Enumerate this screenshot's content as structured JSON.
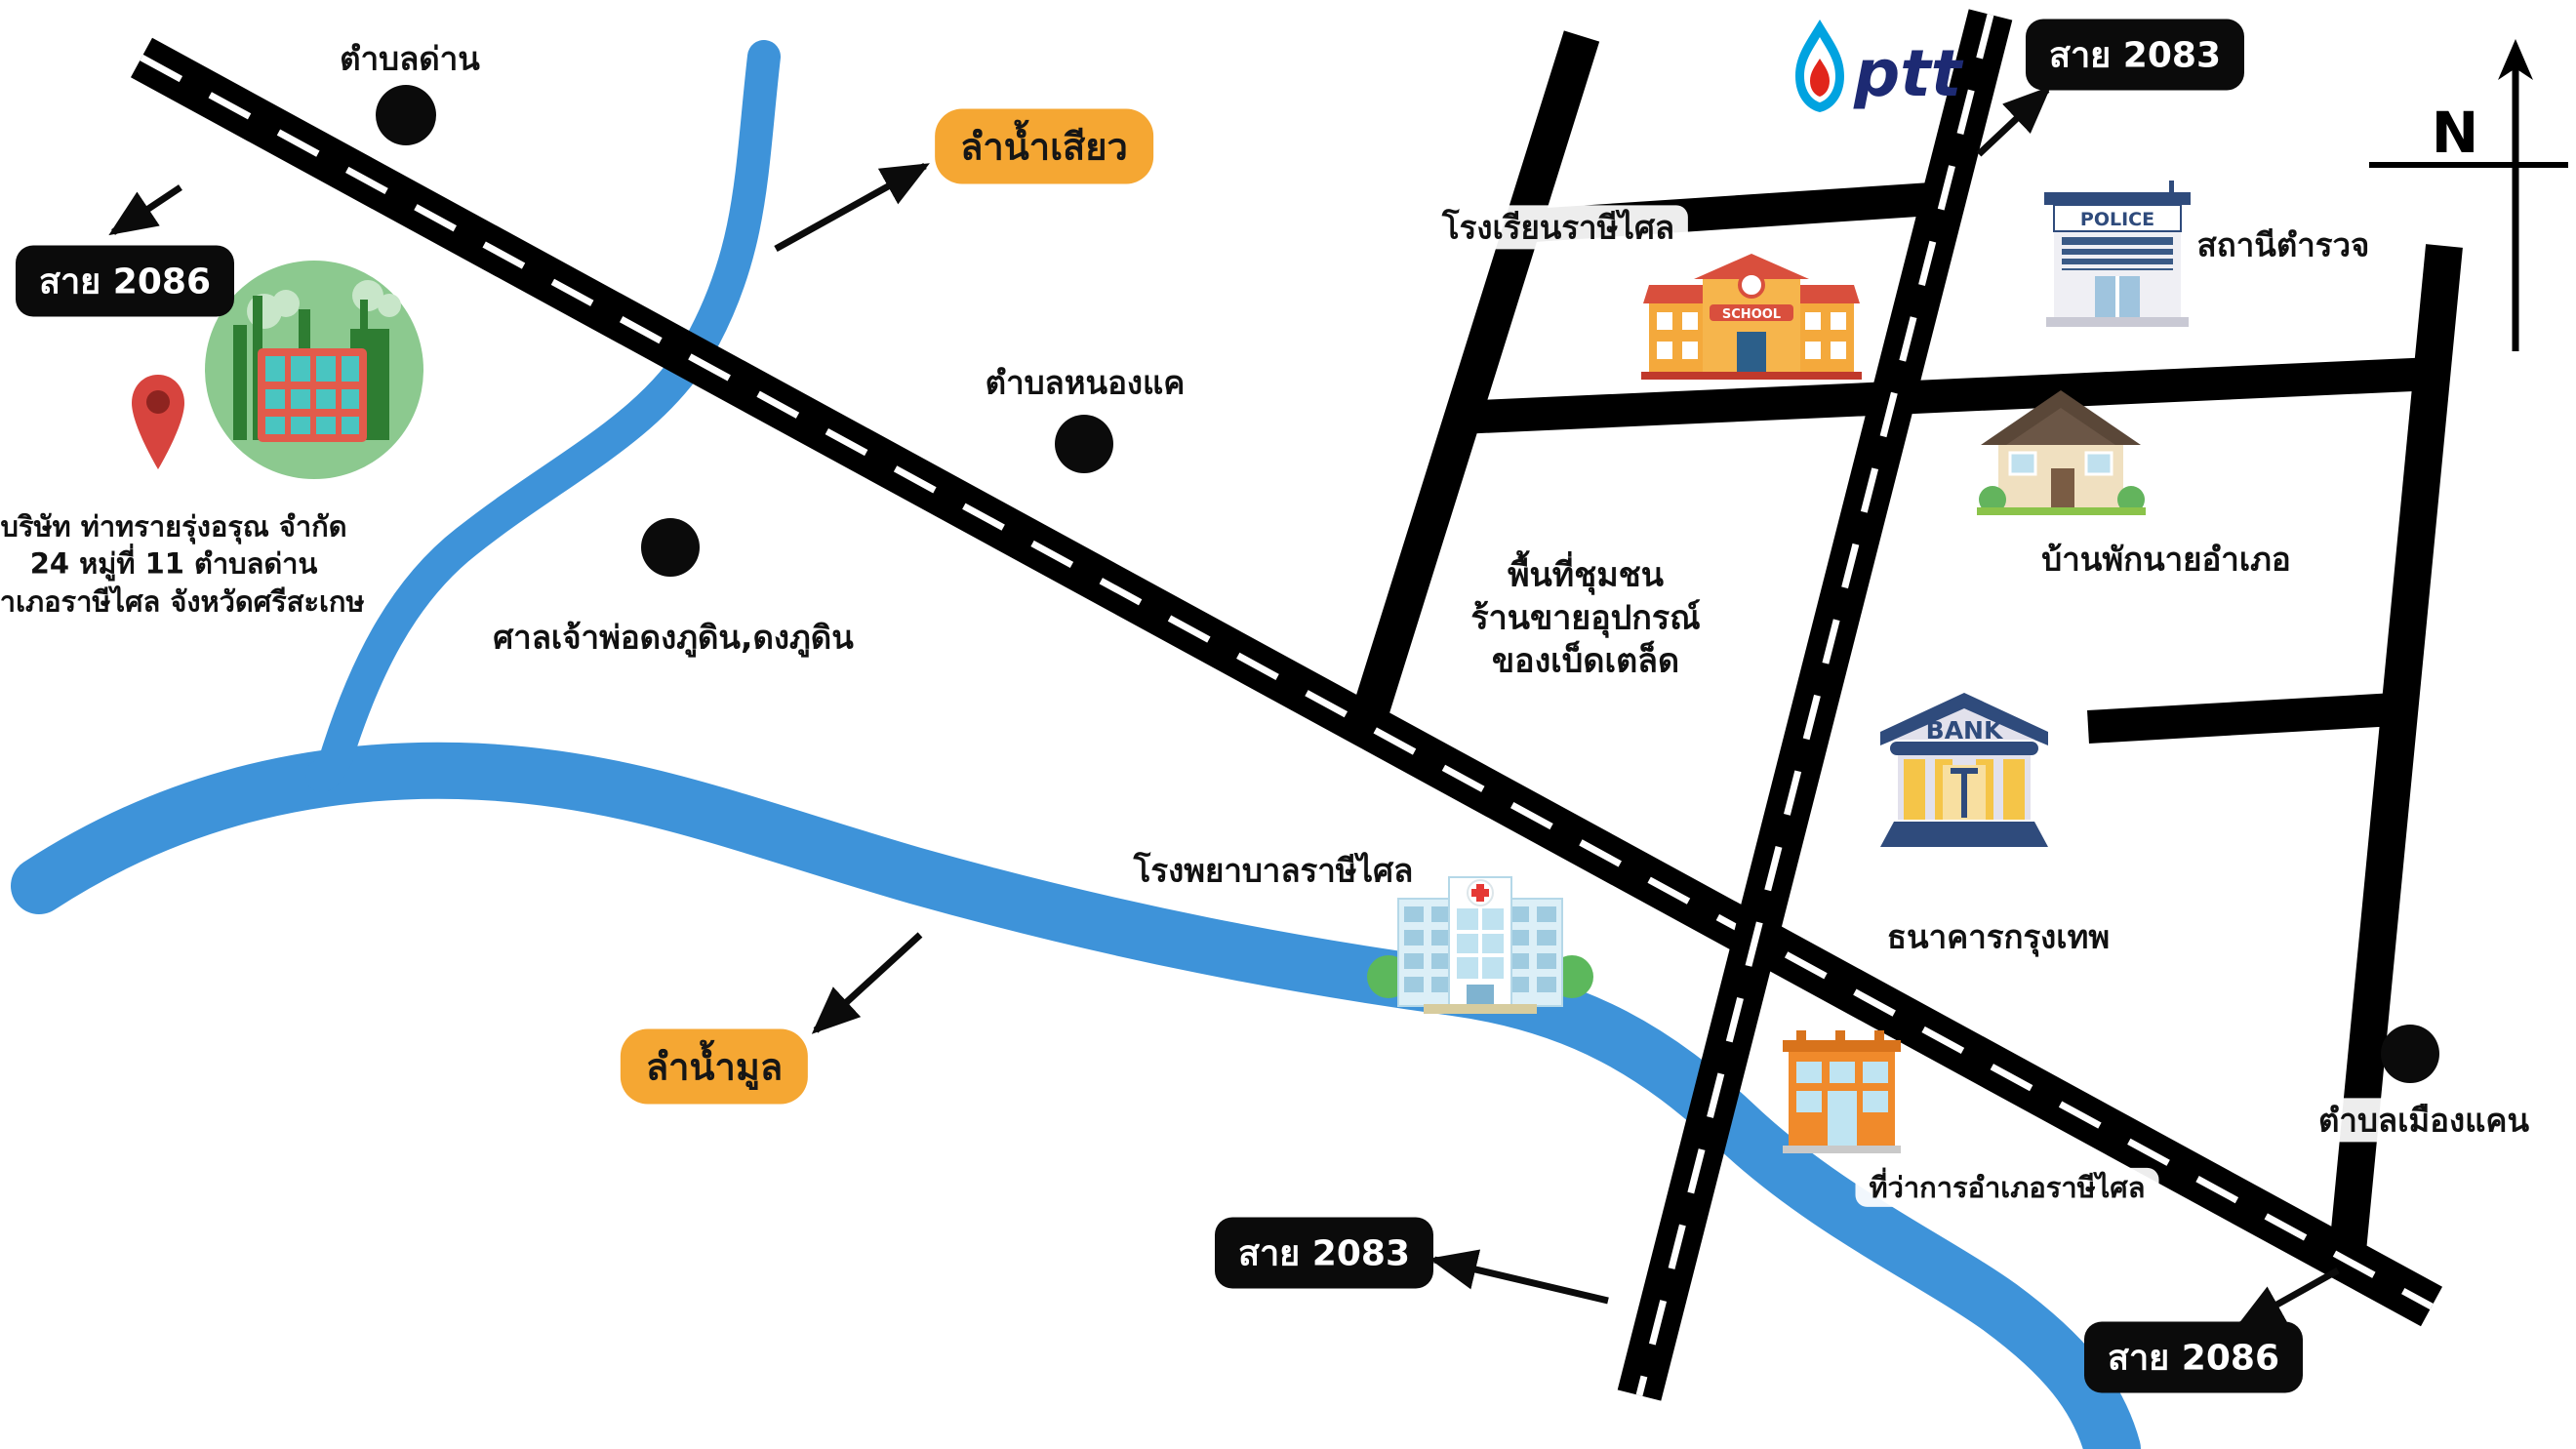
{
  "company": {
    "line1": "บริษัท ท่าทรายรุ่งอรุณ  จำกัด",
    "line2": "24 หมู่ที่ 11 ตำบลด่าน",
    "line3": "อำเภอราษีไศล จังหวัดศรีสะเกษ"
  },
  "districts": {
    "dan": "ตำบลด่าน",
    "nong_khae": "ตำบลหนองแค",
    "mueang_khaen": "ตำบลเมืองแคน",
    "shrine": "ศาลเจ้าพ่อดงภูดิน,ดงภูดิน"
  },
  "landmarks": {
    "school": "โรงเรียนราษีไศล",
    "police": "สถานีตำรวจ",
    "official_house": "บ้านพักนายอำเภอ",
    "community_line1": "พื้นที่ชุมชน",
    "community_line2": "ร้านขายอุปกรณ์",
    "community_line3": "ของเบ็ดเตล็ด",
    "bank": "ธนาคารกรุงเทพ",
    "hospital": "โรงพยาบาลราษีไศล",
    "district_office": "ที่ว่าการอำเภอราษีไศล"
  },
  "routes": {
    "r2086_topleft": "สาย 2086",
    "r2083_topright": "สาย 2083",
    "r2083_bottom": "สาย 2083",
    "r2086_bottomright": "สาย 2086"
  },
  "rivers": {
    "siao": "ลำน้ำเสียว",
    "mun": "ลำน้ำมูล"
  },
  "icon_texts": {
    "bank_sign": "BANK",
    "police_sign": "POLICE",
    "school_sign": "SCHOOL",
    "ptt": "ptt",
    "compass_north": "N"
  },
  "colors": {
    "road": "#000000",
    "road_centerline": "#ffffff",
    "river": "#3E93D9",
    "river_badge": "#F5A733",
    "route_badge_bg": "#0b0b0b",
    "route_badge_text": "#ffffff",
    "ptt_navy": "#1D2A73",
    "ptt_flame_blue": "#00A3E0",
    "ptt_flame_red": "#E1251B"
  }
}
